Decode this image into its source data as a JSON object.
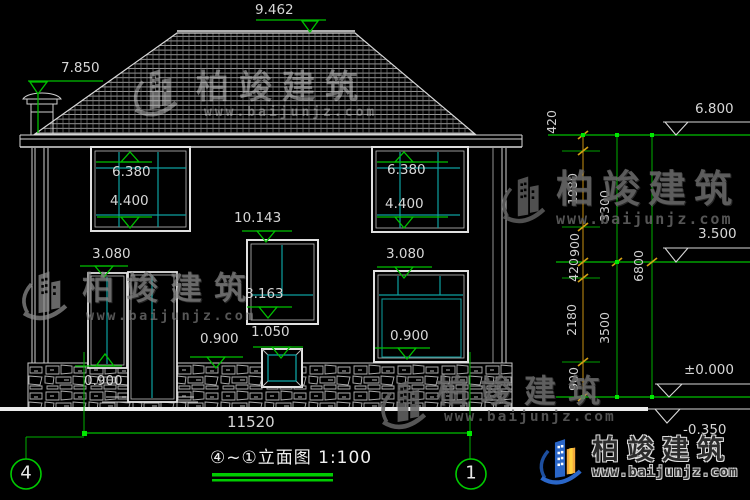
{
  "drawing": {
    "title": "④~①立面图 1:100",
    "axis_left": "4",
    "axis_right": "1",
    "overall_width": "11520"
  },
  "levels": {
    "ridge": "9.462",
    "left_eave": "7.850",
    "right_eave": "6.800",
    "second_floor": "3.500",
    "ground": "±0.000",
    "site": "-0.350"
  },
  "openings": {
    "upper_left_window_top": "6.380",
    "upper_left_window_bottom": "4.400",
    "upper_right_window_top": "6.380",
    "upper_right_window_bottom": "4.400",
    "stair_window_top": "10.143",
    "stair_window_mid": "8.163",
    "entry_door_top": "3.080",
    "entry_door_sill": "0.900",
    "plinth_sill": "0.900",
    "plinth_window_top": "1.050",
    "lower_right_window_top": "3.080",
    "lower_right_window_sill": "0.900"
  },
  "dim_chain": {
    "segments": [
      "420",
      "1980",
      "900",
      "420",
      "2180",
      "900"
    ],
    "floor_heights": [
      "3300",
      "3500"
    ],
    "total": "6800"
  },
  "watermark": {
    "brand": "柏竣建筑",
    "url": "www.baijunjz.com"
  },
  "colors": {
    "line_green": "#00c000",
    "line_teal": "#0ca0a0",
    "line_orange": "#c89010",
    "logo_blue": "#2a66c8",
    "logo_orange": "#f3a93c"
  }
}
